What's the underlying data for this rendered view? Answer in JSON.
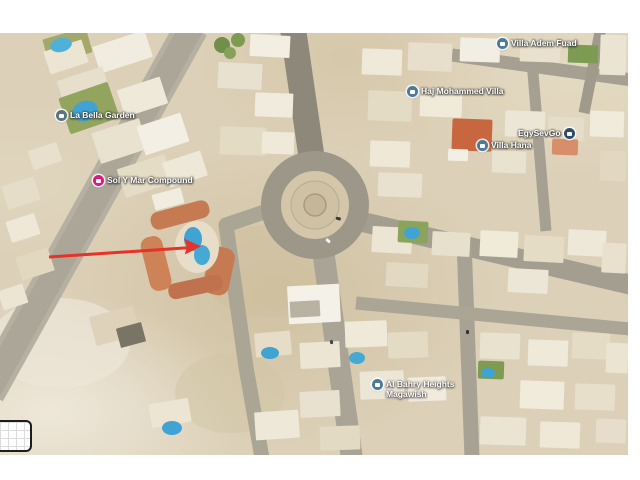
{
  "map": {
    "labels": [
      {
        "name": "la-bella-garden",
        "text": "La Bella Garden",
        "icon": "lodging-icon",
        "icon_color": "#5a7484"
      },
      {
        "name": "sol-y-mar-compound",
        "text": "Sol Y Mar Compound",
        "icon": "hotel-icon",
        "icon_color": "#de1a80"
      },
      {
        "name": "villa-adem-fuad",
        "text": "Villa Adem Fuad",
        "icon": "lodging-icon",
        "icon_color": "#4d7a97"
      },
      {
        "name": "haj-mohammed-villa",
        "text": "Haj Mohammed Villa",
        "icon": "lodging-icon",
        "icon_color": "#4d7a97"
      },
      {
        "name": "egysevgo",
        "text": "EgySevGo",
        "icon": "place-icon",
        "icon_color": "#2f4d68"
      },
      {
        "name": "villa-hana",
        "text": "Villa Hana",
        "icon": "lodging-icon",
        "icon_color": "#4d7a97"
      },
      {
        "name": "al-bahry-heights-magawish",
        "line1": "Al Bahry Heights",
        "line2": "Magawish",
        "icon": "lodging-icon",
        "icon_color": "#4d7a97"
      }
    ],
    "annotation_arrow": {
      "color": "#e63228",
      "points_at": "compound swimming pool"
    },
    "palette": {
      "sand": "#dcd0b8",
      "road": "#a8a294",
      "pool_blue": "#3fa3d4",
      "vegetation_green": "#82a050",
      "building_light": "#f0ebdd",
      "terracotta_roof": "#c57a52",
      "orange_roof": "#c8663f"
    }
  }
}
